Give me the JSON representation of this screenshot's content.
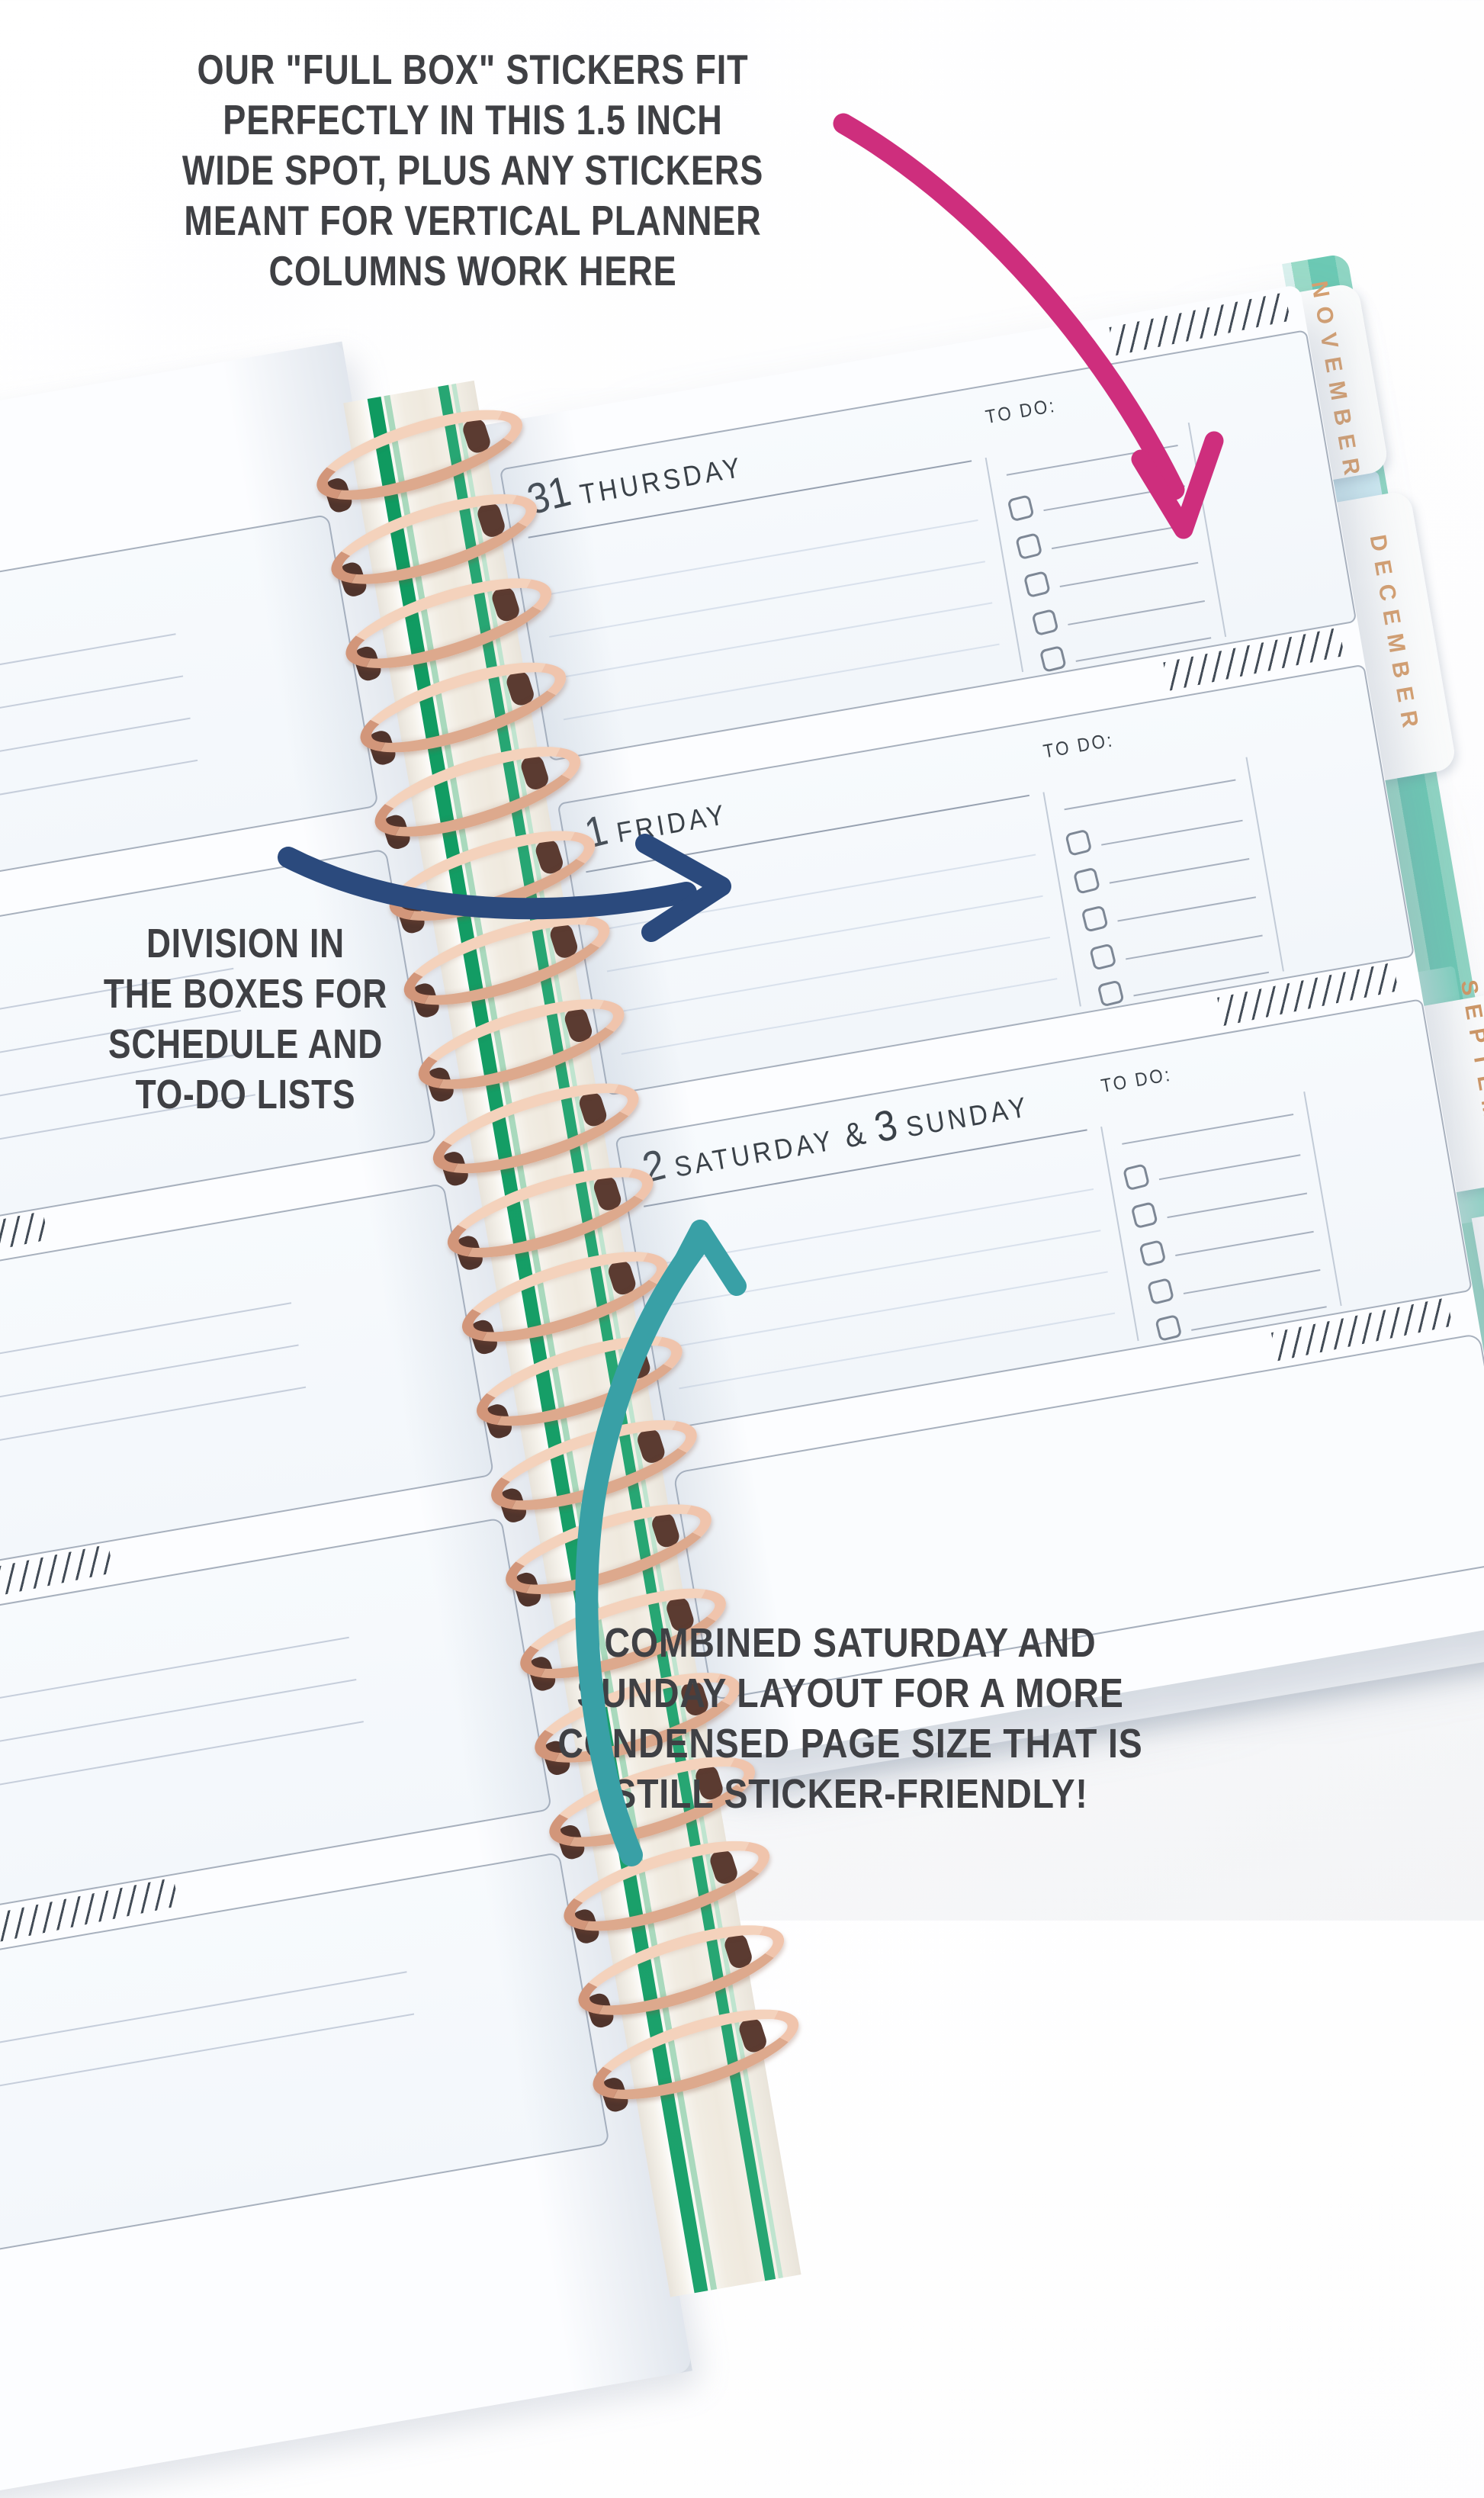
{
  "annotations": {
    "top_note": {
      "lines": [
        "OUR \"FULL BOX\" STICKERS FIT",
        "PERFECTLY IN THIS 1.5 INCH",
        "WIDE SPOT, PLUS ANY STICKERS",
        "MEANT FOR VERTICAL PLANNER",
        "COLUMNS WORK HERE"
      ],
      "color": "#3f4044"
    },
    "left_note": {
      "lines": [
        "DIVISION IN",
        "THE BOXES FOR",
        "SCHEDULE AND",
        "TO-DO LISTS"
      ],
      "color": "#3f4044"
    },
    "bottom_note": {
      "lines": [
        "COMBINED SATURDAY AND",
        "SUNDAY LAYOUT FOR A MORE",
        "CONDENSED PAGE SIZE THAT IS",
        "STILL STICKER-FRIENDLY!"
      ],
      "color": "#3f4044"
    }
  },
  "arrows": {
    "pink": {
      "color": "#ce2e7d"
    },
    "navy": {
      "color": "#2b4a7d"
    },
    "teal": {
      "color": "#39a0a6"
    }
  },
  "planner": {
    "right_page": {
      "days": [
        {
          "date": "31",
          "name": "THURSDAY",
          "todo_label": "TO DO:"
        },
        {
          "date": "1",
          "name": "FRIDAY",
          "todo_label": "TO DO:"
        },
        {
          "date": "2",
          "name": "SATURDAY",
          "joiner": "&",
          "date2": "3",
          "name2": "SUNDAY",
          "todo_label": "TO DO:"
        }
      ]
    },
    "tabs": [
      {
        "label": "NOVEMBER"
      },
      {
        "label": "DECEMBER"
      },
      {
        "label": "SEPTEMBER"
      },
      {
        "label": "OCTOBER"
      }
    ],
    "colors": {
      "cover_teal": "#8fd5c3",
      "tab_text_gold": "#d8a06f",
      "coil_rose_gold": "#e6b298",
      "spine_stripe_green": "#1da26d",
      "page": "#fcfdff",
      "box_border": "#a7b0bd"
    }
  }
}
